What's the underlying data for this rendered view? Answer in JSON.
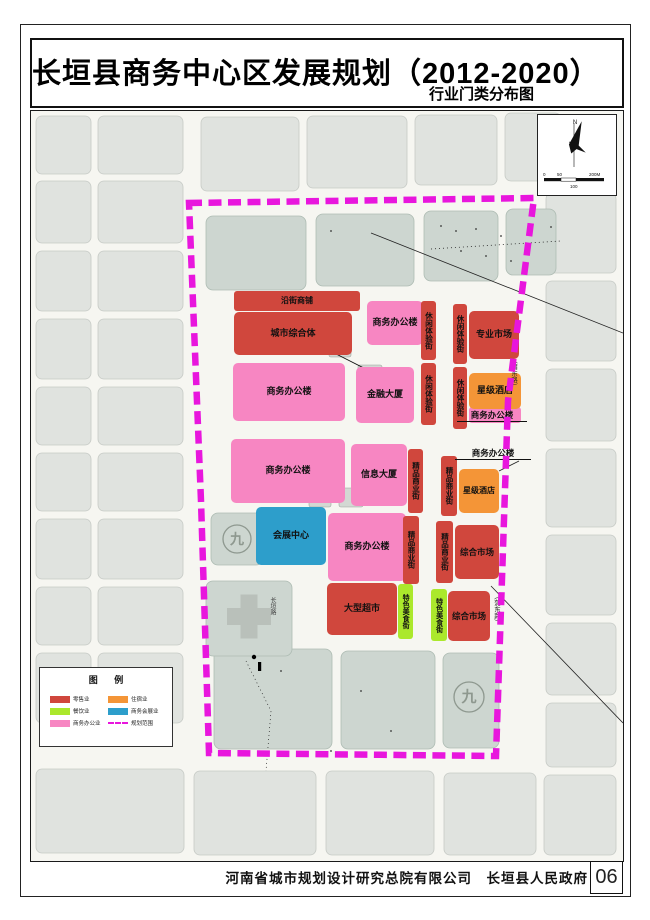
{
  "page": {
    "title": "长垣县商务中心区发展规划（2012-2020）",
    "subtitle": "行业门类分布图",
    "footer": "河南省城市规划设计研究总院有限公司　长垣县人民政府",
    "page_number": "06"
  },
  "labels": {
    "yanjie": "沿街商铺",
    "zongheti": "城市综合体",
    "bangonglou": "商务办公楼",
    "xiuxian": "休闲体验街",
    "zhuanye": "专业市场",
    "jinrong": "金融大厦",
    "xingji": "星级酒店",
    "xinxi": "信息大厦",
    "jingpin": "精品商业街",
    "huizhan": "会展中心",
    "zonghe": "综合市场",
    "chaoshi": "大型超市",
    "meishi": "特色美食街"
  },
  "symbols": {
    "school": "九"
  },
  "roads": {
    "changyuan": "长垣路",
    "east": "（蒲东路）"
  },
  "compass": {
    "north": "N"
  },
  "scale": {
    "s0": "0",
    "s50": "50",
    "s100": "100",
    "s200": "200M"
  },
  "legend": {
    "title": "图 例",
    "items": [
      {
        "label": "零售业",
        "color": "#d0473d",
        "type": "fill"
      },
      {
        "label": "餐饮业",
        "color": "#abe82c",
        "type": "fill"
      },
      {
        "label": "商务办公业",
        "color": "#f786c2",
        "type": "fill"
      },
      {
        "label": "住宿业",
        "color": "#f49537",
        "type": "fill"
      },
      {
        "label": "商务会展业",
        "color": "#2d9ecb",
        "type": "fill"
      },
      {
        "label": "规划范围",
        "color": "#e816dd",
        "type": "dash"
      }
    ]
  },
  "colors": {
    "retail_red": "#d0473d",
    "food_green": "#abe82c",
    "office_pink": "#f786c2",
    "hotel_orange": "#f49537",
    "expo_blue": "#2d9ecb",
    "boundary_magenta": "#e816dd"
  }
}
